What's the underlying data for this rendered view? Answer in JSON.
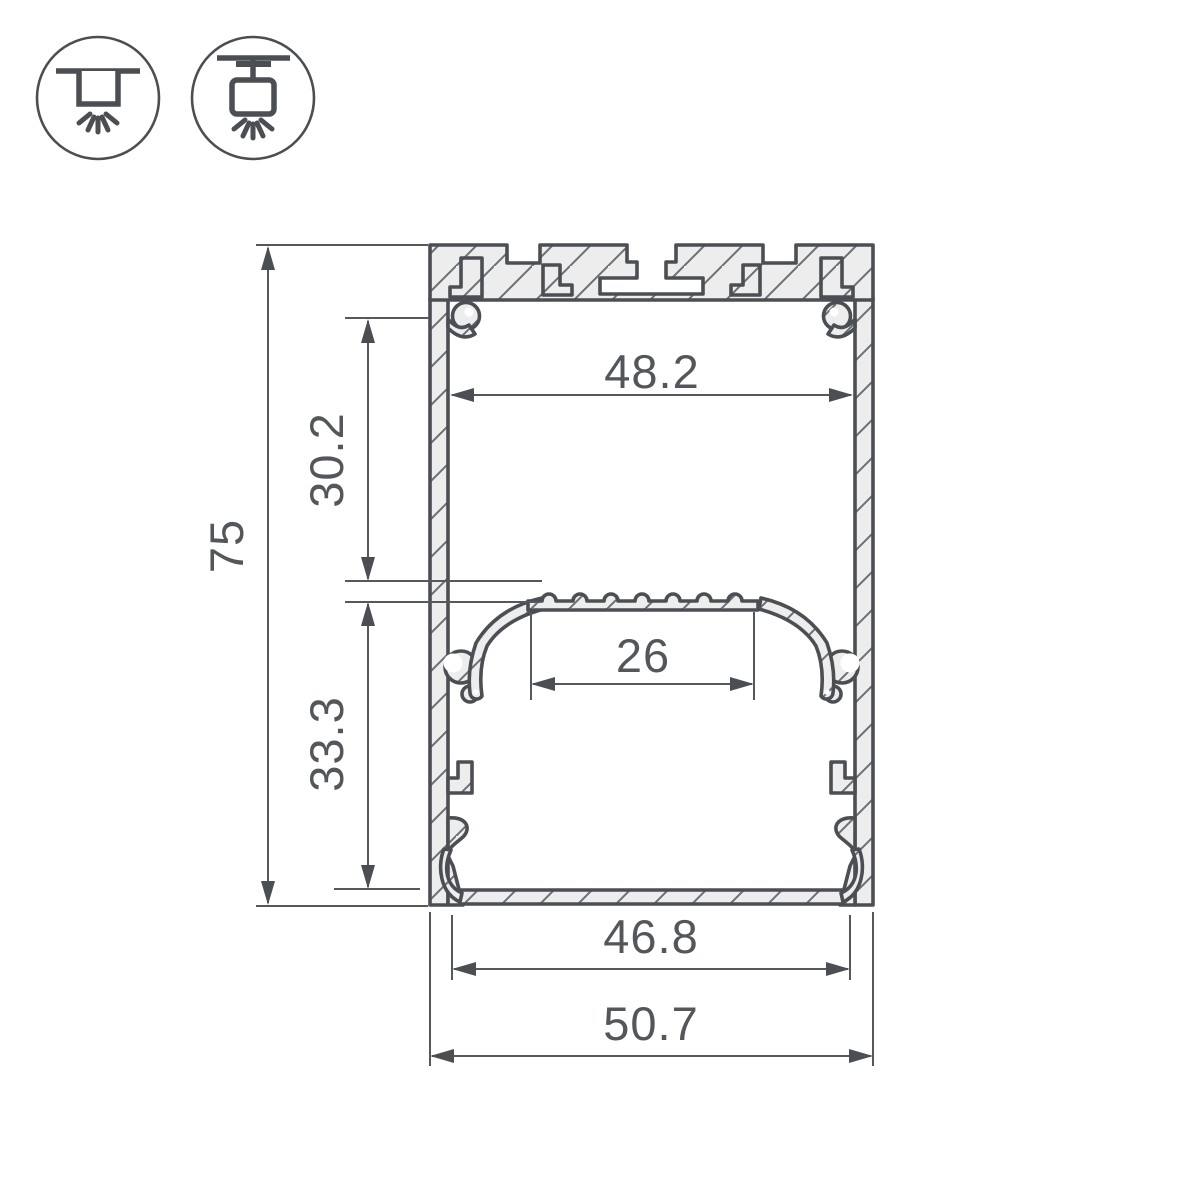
{
  "title": "LED aluminium profile cross-section technical drawing",
  "icons": {
    "surface_mount": "surface-ceiling-mount-icon",
    "pendant_mount": "suspended-pendant-mount-icon"
  },
  "dimensions": {
    "overall_height": "75",
    "top_inner_width": "48.2",
    "upper_section_height": "30.2",
    "led_platform_width": "26",
    "lower_section_height": "33.3",
    "bottom_inner_width": "46.8",
    "overall_width": "50.7"
  },
  "colors": {
    "line": "#4b4f54",
    "metal_fill": "#ededee",
    "text": "#53575b",
    "background": "#ffffff"
  }
}
